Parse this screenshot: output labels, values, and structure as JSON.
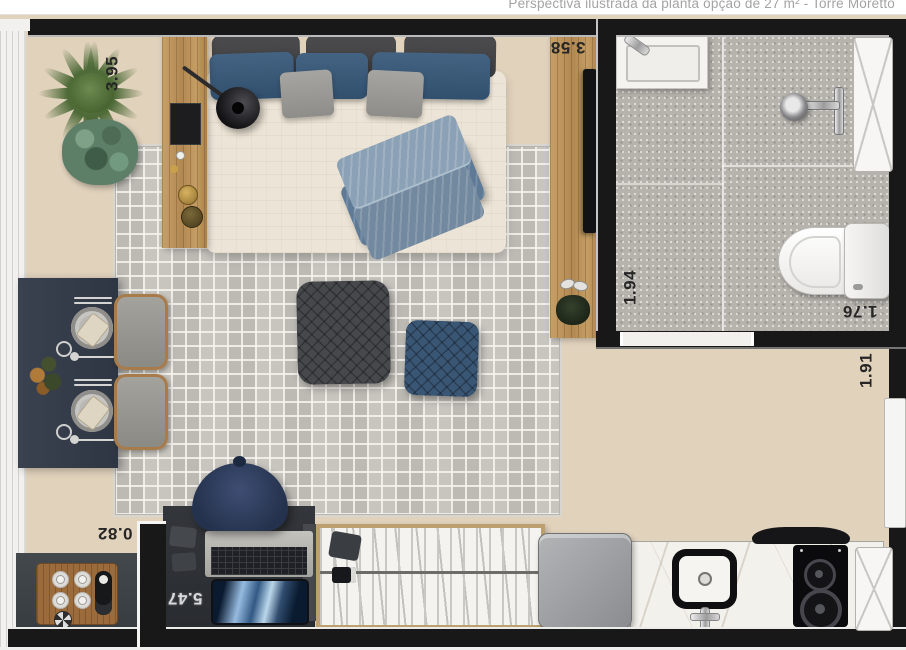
{
  "caption": "Perspectiva ilustrada da planta opção de 27 m² - Torre Moretto",
  "dimensions": {
    "living_width": "3.95",
    "tv_wall_length": "3.58",
    "bathroom_width": "1.94",
    "bathroom_length": "1.76",
    "entry_nook_width": "1.91",
    "kitchen_corner_depth": "0.82",
    "apartment_length": "5.47"
  },
  "rooms": [
    "living-bedroom",
    "bathroom",
    "kitchenette",
    "entry"
  ],
  "elements": [
    "potted-plant",
    "double-bed",
    "headboard-panel",
    "wall-lamp",
    "throw-blanket",
    "tv-panel",
    "area-rug",
    "pouf-large",
    "pouf-small",
    "dining-table",
    "dining-chairs",
    "office-chair",
    "desk",
    "laptop",
    "bookshelf",
    "refrigerator",
    "kitchen-sink",
    "cooktop",
    "range-hood",
    "corner-counter",
    "bathroom-sink",
    "shower",
    "toilet",
    "entry-door",
    "window"
  ],
  "colors": {
    "wall": "#181818",
    "wood_floor": "#e1d2bc",
    "rug": "#c8c5bf",
    "navy": "#33435c",
    "panel_wood": "#bb9157",
    "bath_tile": "#b6b3ad",
    "marble": "#f3f1ec",
    "caption_text": "#a3a3a3"
  }
}
